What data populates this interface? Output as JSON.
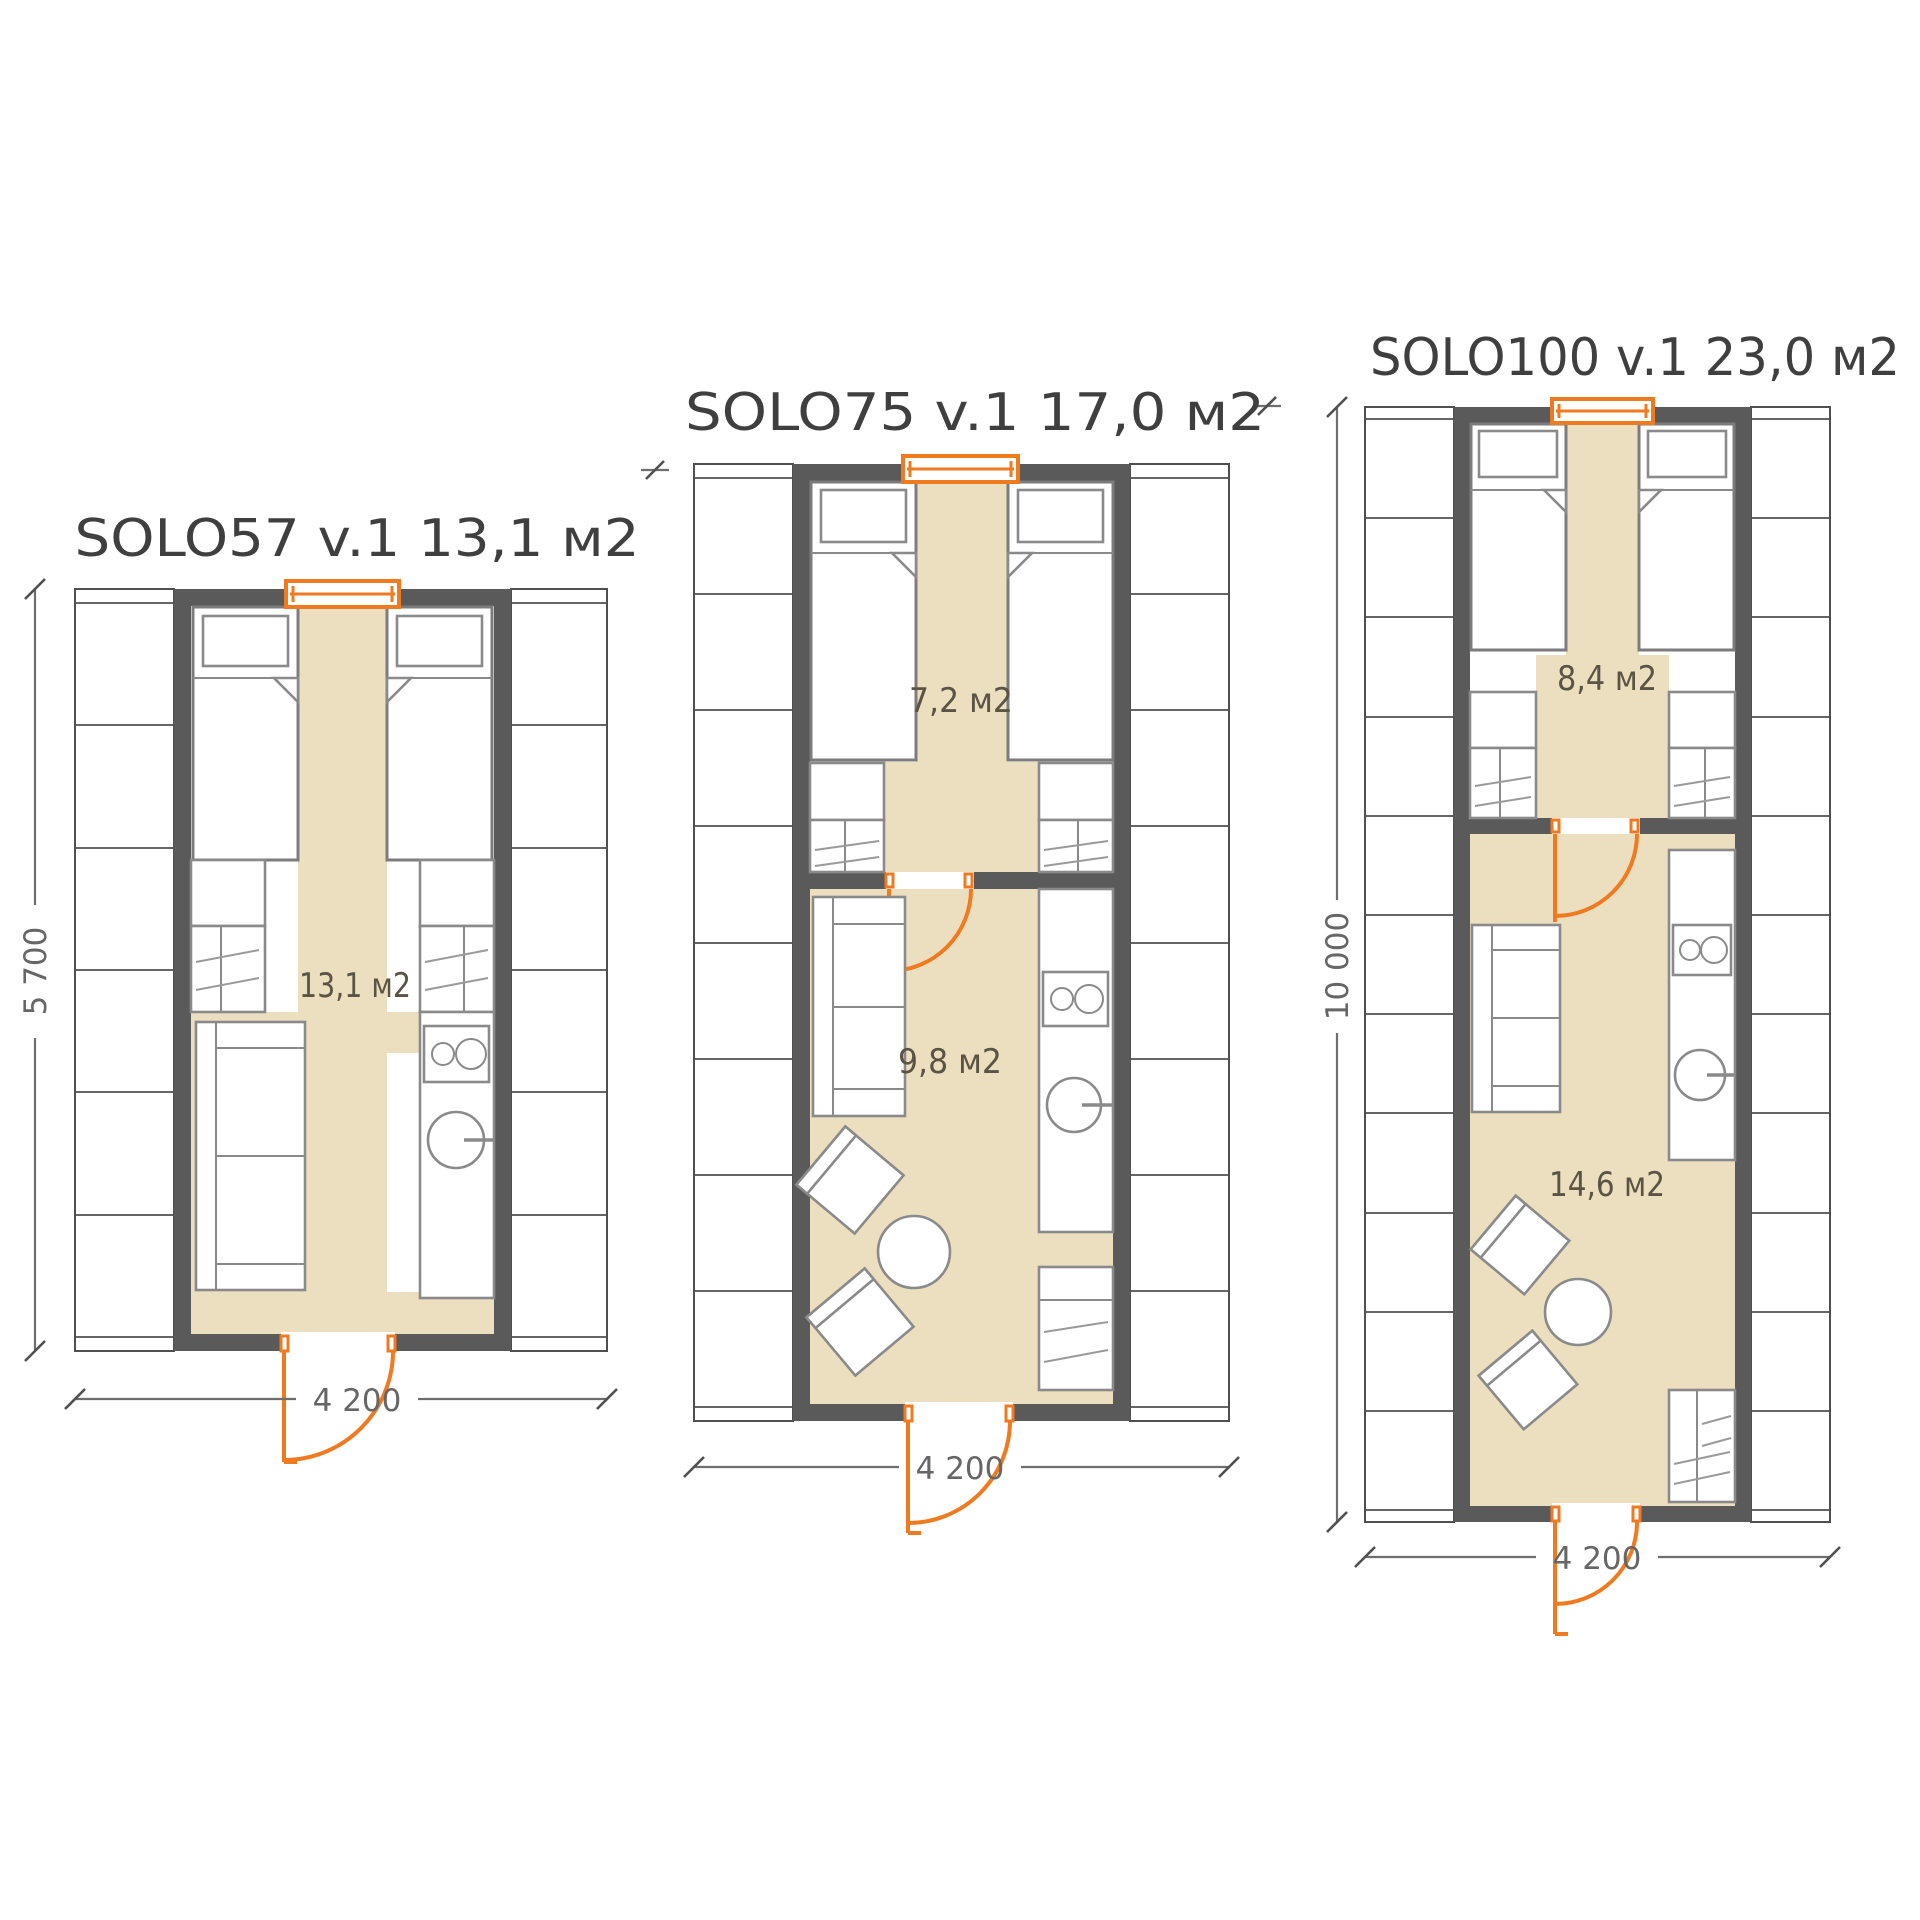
{
  "page": {
    "background": "#ffffff",
    "type": "floor-plan-sheet"
  },
  "colors": {
    "wall": "#5a5a5a",
    "accent_orange": "#f07a20",
    "floor_beige": "#ecdfc0",
    "furniture_line": "#8a8a8a",
    "dimension_line": "#6e6e6e",
    "title_text": "#3f3f3f",
    "area_text": "#5b5445"
  },
  "plans": [
    {
      "id": "solo57",
      "title": "SOLO57 v.1 13,1 м2",
      "width_label": "4 200",
      "height_label": "5 700",
      "rooms": [
        {
          "name": "studio",
          "area_label": "13,1 м2"
        }
      ]
    },
    {
      "id": "solo75",
      "title": "SOLO75 v.1 17,0 м2",
      "width_label": "4 200",
      "rooms": [
        {
          "name": "bedroom",
          "area_label": "7,2 м2"
        },
        {
          "name": "living-kitchen",
          "area_label": "9,8 м2"
        }
      ]
    },
    {
      "id": "solo100",
      "title": "SOLO100 v.1 23,0 м2",
      "width_label": "4 200",
      "height_label": "10 000",
      "rooms": [
        {
          "name": "bedroom",
          "area_label": "8,4 м2"
        },
        {
          "name": "living-kitchen",
          "area_label": "14,6 м2"
        }
      ]
    }
  ]
}
